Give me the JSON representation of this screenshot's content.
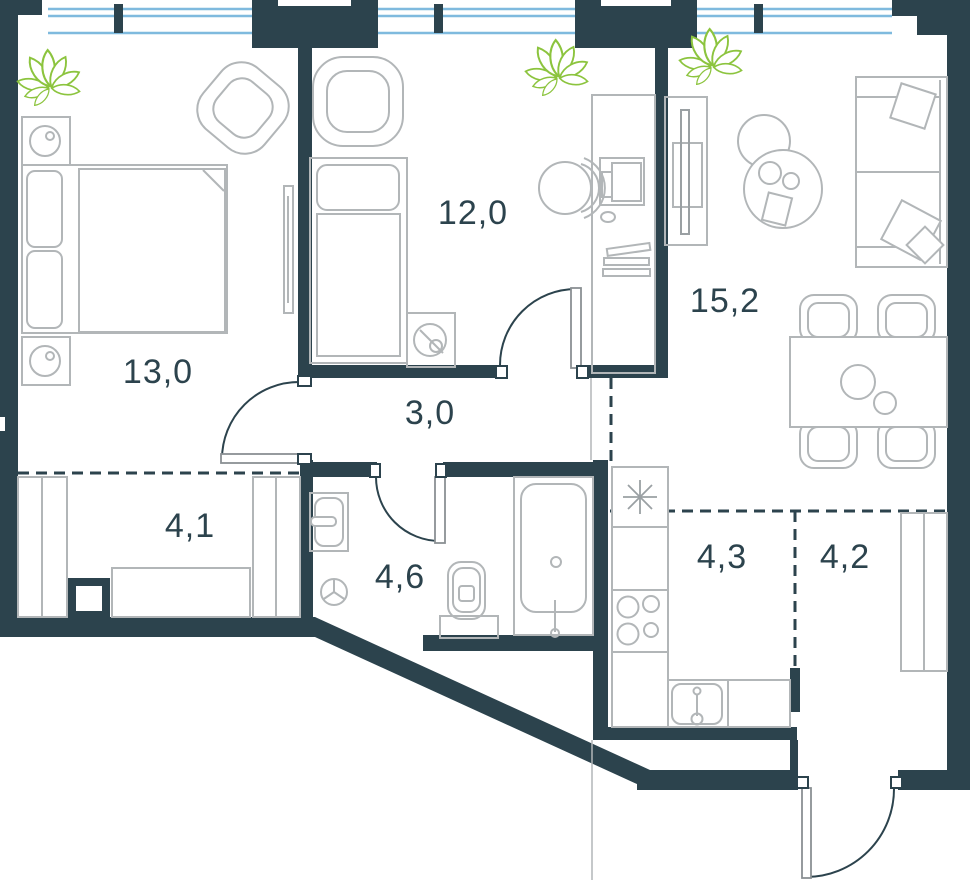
{
  "plan": {
    "title": "apartment-floor-plan",
    "rooms": [
      {
        "id": "bedroom-main",
        "area": "13,0",
        "fixtures": [
          "double-bed",
          "nightstand",
          "nightstand",
          "armchair",
          "plant",
          "wall-tv",
          "window"
        ]
      },
      {
        "id": "bedroom-second",
        "area": "12,0",
        "fixtures": [
          "single-bed",
          "armchair",
          "washing-machine",
          "desk",
          "desk-chair",
          "monitor",
          "plant",
          "window"
        ]
      },
      {
        "id": "hallway",
        "area": "3,0",
        "fixtures": []
      },
      {
        "id": "living-room",
        "area": "15,2",
        "fixtures": [
          "sofa",
          "pillows",
          "tv-console",
          "coffee-tables",
          "dining-table",
          "four-chairs",
          "plant",
          "window"
        ]
      },
      {
        "id": "wardrobe",
        "area": "4,1",
        "fixtures": [
          "closet",
          "closet",
          "bench",
          "column"
        ]
      },
      {
        "id": "bathroom",
        "area": "4,6",
        "fixtures": [
          "washbasin",
          "toilet",
          "bathtub",
          "vent"
        ]
      },
      {
        "id": "kitchen-zone",
        "area": "4,3",
        "fixtures": [
          "counter",
          "stove",
          "sink",
          "asterisk-symbol"
        ]
      },
      {
        "id": "entry-zone",
        "area": "4,2",
        "fixtures": [
          "closet",
          "entrance-door"
        ]
      }
    ],
    "colors": {
      "wall": "#2c434d",
      "furniture_line": "#b2b6b8",
      "window_glass": "#7fbade",
      "plant_green": "#8cc43e",
      "background": "#ffffff",
      "label_text": "#2c434d"
    }
  }
}
